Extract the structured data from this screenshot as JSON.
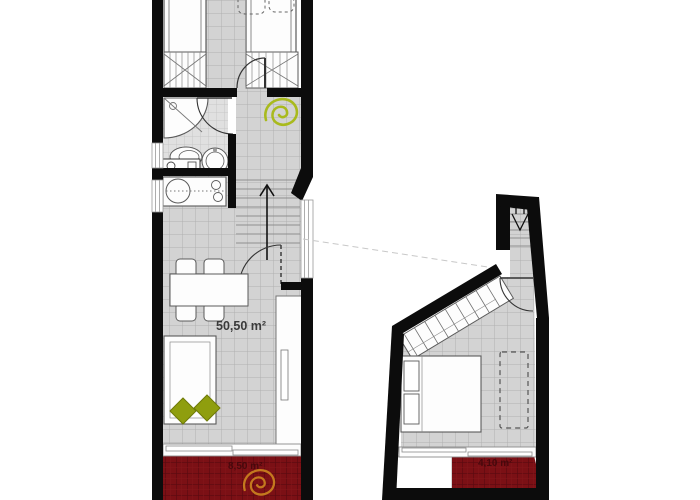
{
  "plan": {
    "name": "apartment-floor-plan",
    "labels": {
      "living_area": "50,50 m²",
      "terrace_left_area": "8,50 m²",
      "terrace_right_area": "4,10 m²"
    },
    "colors": {
      "wall": "#0c0c0c",
      "tile_floor": "#d3d3d3",
      "tile_line": "#b0b0b0",
      "bath_tile": "#e0e0e0",
      "terrace_red": "#7b1015",
      "terrace_line": "#5a0a0f",
      "terrace_text": "#43080c",
      "accent_green_spiral": "#a9ba1d",
      "accent_olive_cushion": "#8f9e0e",
      "accent_orange_spiral": "#c4791e",
      "furniture_line": "#555555",
      "label_text": "#3a3a3a"
    },
    "icons": [
      "spiral-logo-green",
      "spiral-logo-orange",
      "stairs-up-arrow",
      "stairs-down-arrow"
    ]
  }
}
